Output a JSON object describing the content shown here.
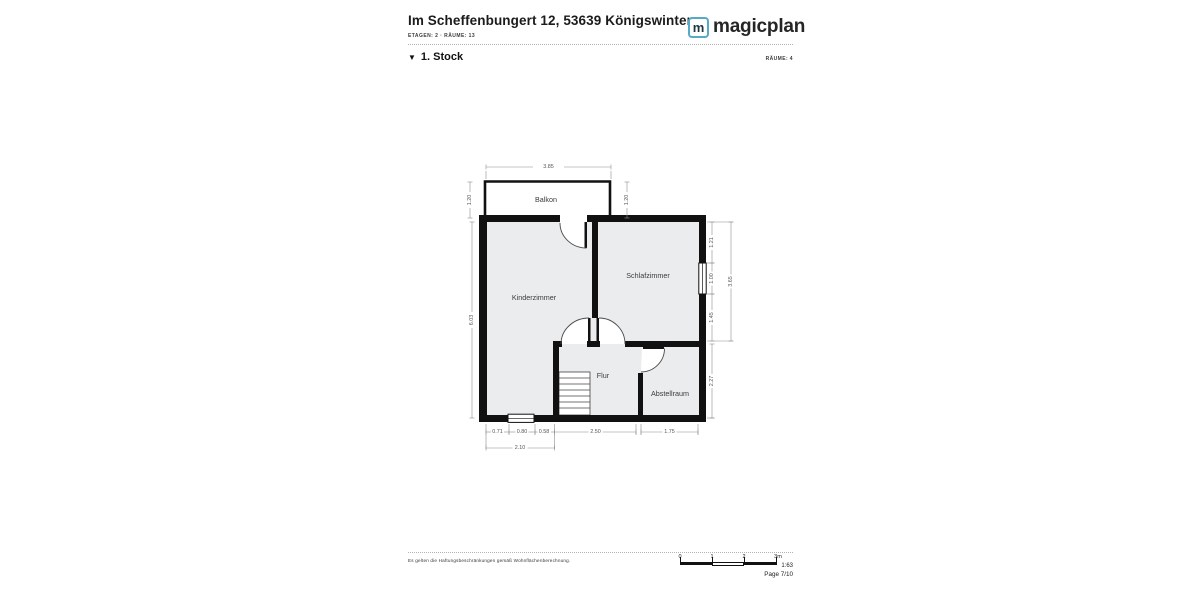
{
  "header": {
    "title": "Im Scheffenbungert 12, 53639 Königswinter",
    "subtitle": "ETAGEN: 2 · RÄUME: 13",
    "logo": {
      "letter": "m",
      "wordmark": "magicplan"
    }
  },
  "section": {
    "collapse_icon": "▼",
    "floor_label": "1. Stock",
    "rooms_count": "RÄUME: 4"
  },
  "floorplan": {
    "rooms": {
      "balkon": "Balkon",
      "schlafzimmer": "Schlafzimmer",
      "kinderzimmer": "Kinderzimmer",
      "flur": "Flur",
      "abstellraum": "Abstellraum"
    },
    "dimensions": {
      "top_width": "3.85",
      "balkon_left": "1.20",
      "balkon_right": "1.20",
      "left_height": "6.03",
      "right_seg1": "1.21",
      "right_window": "1.00",
      "right_seg3": "1.45",
      "right_total": "3.65",
      "abstellraum_height": "2.27",
      "bottom_seg1": "0.71",
      "bottom_window": "0.80",
      "bottom_seg3": "0.58",
      "flur_width": "2.50",
      "abstellraum_width": "1.75",
      "bottom_total": "2.10"
    }
  },
  "footer": {
    "disclaimer": "Es gelten die Haftungsbeschränkungen gemäß Wohnflächenberechnung.",
    "scale_ticks": [
      "0",
      "1",
      "2",
      "3m"
    ],
    "scale_ratio": "1:63",
    "page_label": "Page 7/10"
  },
  "colors": {
    "accent": "#57a9c9",
    "wall": "#111111",
    "room_fill": "#ebecee"
  }
}
